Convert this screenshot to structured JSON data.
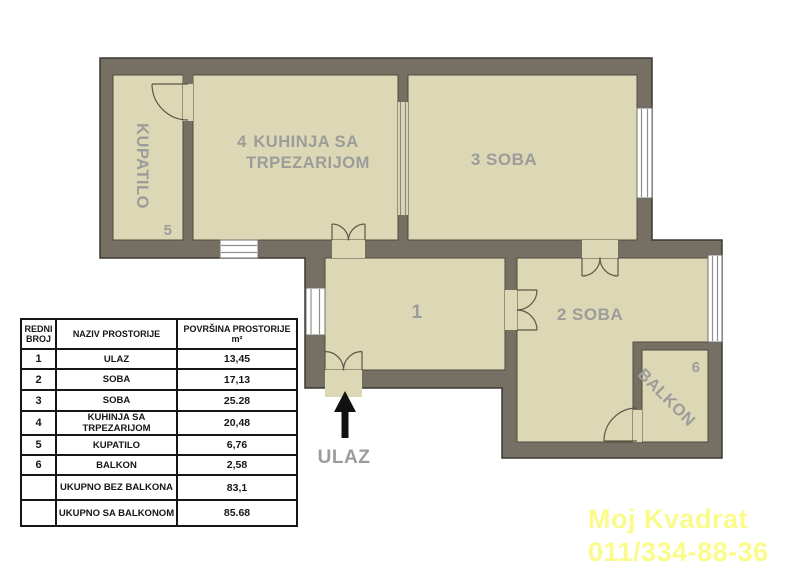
{
  "plan": {
    "labels": {
      "kupatilo": "KUPATILO",
      "kupatilo_num": "5",
      "kuhinja_prefix": "4",
      "kuhinja_line1": "KUHINJA SA",
      "kuhinja_line2": "TRPEZARIJOM",
      "soba3": "3 SOBA",
      "hodnik_num": "1",
      "soba2": "2 SOBA",
      "balkon": "BALKON",
      "balkon_num": "6",
      "entrance": "ULAZ"
    }
  },
  "table": {
    "headers": {
      "col1": "REDNI BROJ",
      "col2": "NAZIV PROSTORIJE",
      "col3": "POVRŠINA PROSTORIJE m²"
    },
    "rows": [
      {
        "num": "1",
        "name": "ULAZ",
        "area": "13,45"
      },
      {
        "num": "2",
        "name": "SOBA",
        "area": "17,13"
      },
      {
        "num": "3",
        "name": "SOBA",
        "area": "25.28"
      },
      {
        "num": "4",
        "name": "KUHINJA SA TRPEZARIJOM",
        "area": "20,48"
      },
      {
        "num": "5",
        "name": "KUPATILO",
        "area": "6,76"
      },
      {
        "num": "6",
        "name": "BALKON",
        "area": "2,58"
      },
      {
        "num": "",
        "name": "UKUPNO BEZ BALKONA",
        "area": "83,1"
      },
      {
        "num": "",
        "name": "UKUPNO SA BALKONOM",
        "area": "85.68"
      }
    ]
  },
  "watermark": {
    "line1": "Moj Kvadrat",
    "line2": "011/334-88-36",
    "color": "#fbfb8b"
  },
  "colors": {
    "wall": "#756f64",
    "room": "#dcd7b5",
    "label": "#9c9c9a",
    "window": "#ffffff",
    "arrow": "#111111"
  }
}
